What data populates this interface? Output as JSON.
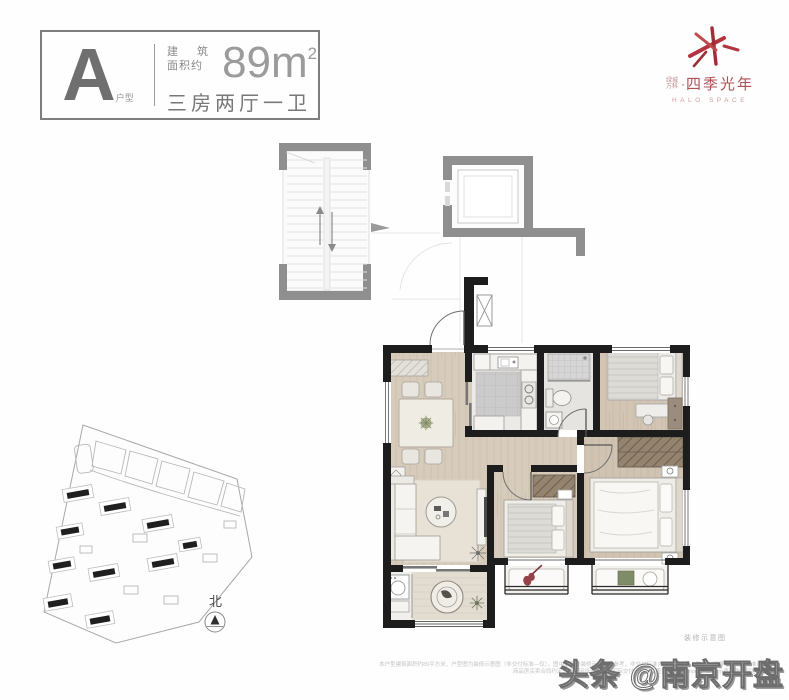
{
  "badge": {
    "unit_letter": "A",
    "unit_type_label": "户型",
    "area_label_line1": "建 筑",
    "area_label_line2": "面积约",
    "area_value": "89m",
    "area_superscript": "2",
    "rooms_summary": "三房两厅一卫"
  },
  "logo": {
    "brand_prefix_line1": "绿城",
    "brand_prefix_line2": "万科",
    "separator": "·",
    "project_name": "四季光年",
    "project_name_en": "HALO SPACE",
    "accent_color": "#b5353d"
  },
  "floor_plan": {
    "caption": "装修示意图"
  },
  "site_plan": {
    "north_label": "北"
  },
  "footer": {
    "disclaimer_line1": "本户型建筑面积约89平方米，户型图为装修示意图（非交付标准—仅），图中家具及装修示意仅供参考，非交付标准内容，含家具、陈设、绿植等，交付标准以",
    "disclaimer_line2": "商品房买卖合同约定为准；因设计调整，实际交付可能存在差异，规格、постачання示意，敬请留意。",
    "watermark": "头条 @南京开盘"
  }
}
